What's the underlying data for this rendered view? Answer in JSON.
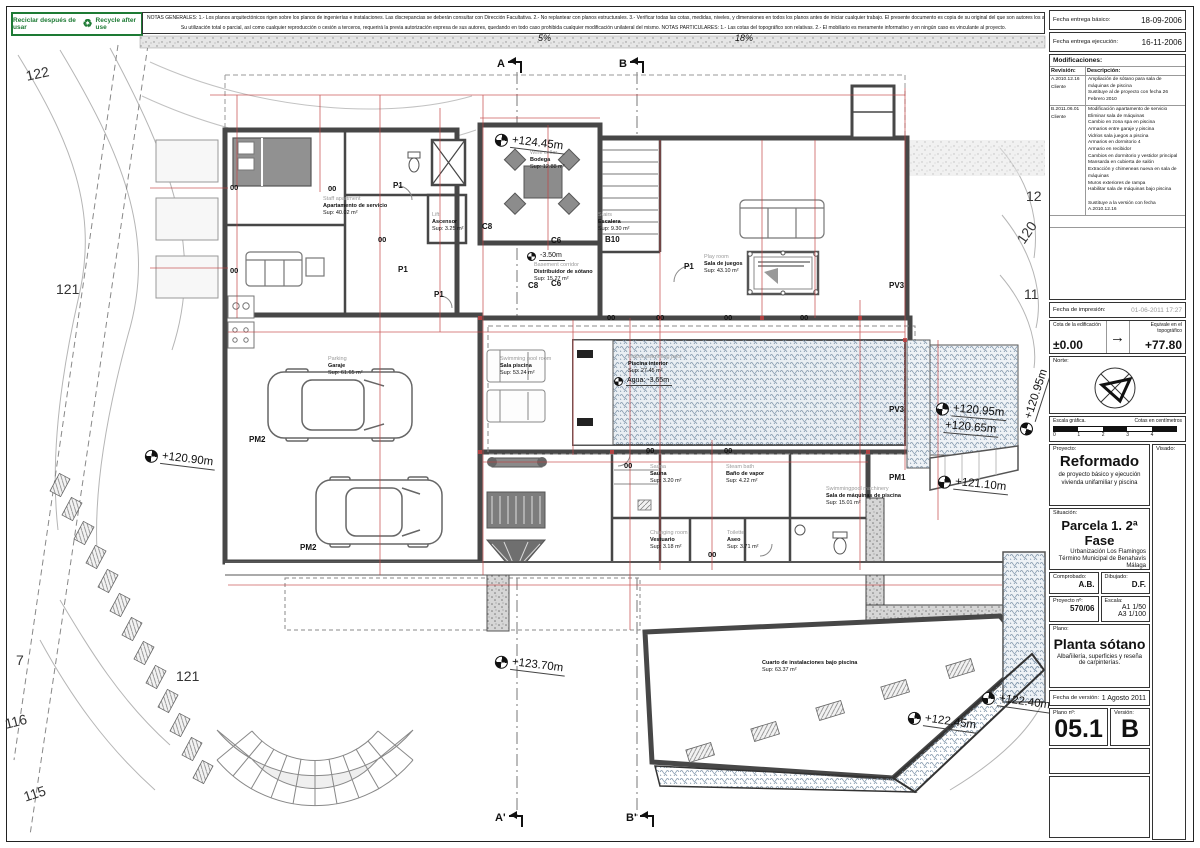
{
  "sheet": {
    "recycle_left": "Reciclar después de usar",
    "recycle_right": "Recycle after use",
    "notes_line1": "NOTAS GENERALES:   1.- Los planos arquitectónicos rigen sobre los planos de ingenierías e instalaciones. Las discrepancias se deberán consultar con Dirección Facultativa.   2.- No replantear con planos estructurales.   3.- Verificar todas las cotas, medidas, niveles, y dimensiones en todos los planos antes de iniciar cualquier trabajo. El presente documento es copia de su original del que son autores los arquitectos",
    "notes_line2": "Su utilización total o parcial, así como cualquier reproducción o cesión a terceros, requerirá la previa autorización expresa de sus autores, quedando en todo caso prohibida cualquier modificación unilateral del mismo.   NOTAS PARTICULARES:   1.- Las cotas del topográfico son relativas. 2.- El mobiliario es meramente informativo y en ningún caso es vinculante al proyecto."
  },
  "titleblock": {
    "fecha_basico_label": "Fecha entrega básico:",
    "fecha_basico": "18-09-2006",
    "fecha_ejecucion_label": "Fecha entrega ejecución:",
    "fecha_ejecucion": "16-11-2006",
    "modificaciones_label": "Modificaciones:",
    "revision_col": "Revisión:",
    "descripcion_col": "Descripción:",
    "revisions": [
      {
        "rev": "A.2010.12.16",
        "by": "Cliente",
        "desc": "Ampliación de sótano para sala de máquinas de piscina\nSustituye al de proyecto con fecha 26 Febrero 2010"
      },
      {
        "rev": "B.2011.06.01",
        "by": "Cliente",
        "desc": "Modificación apartamento de servicio\nEliminar sala de máquinas\nCambio en zona spa en piscina\nArmarios entre garaje y piscina\nVidrios sala juegos a piscina\nArmarios en dormitorio 4\nArmario en recibidor\nCambios en dormitorio y vestidor principal\nMansarda en cubierta de salón\nExtracción y chimeneas nueva en sala de máquinas\nMuros exteriores de rampa\nHabilitar sala de máquinas bajo piscina\n\nSustituye a la versión con fecha A.2010.12.16"
      }
    ],
    "fecha_impresion_label": "Fecha de impresión:",
    "fecha_impresion": "01-06-2011 17:27",
    "cota_label": "Cota de la edificación",
    "cota_value": "±0.00",
    "equiv_label": "Equivale en el topográfico",
    "equiv_value": "+77.80",
    "norte_label": "Norte:",
    "escala_grafica_label": "Escala gráfica.",
    "cotas_cm_label": "Cotas en centímetros",
    "scale_ticks": [
      "0",
      "1",
      "2",
      "3",
      "4"
    ],
    "proyecto_label": "Proyecto:",
    "visado_label": "Visado:",
    "proyecto_title": "Reformado",
    "proyecto_sub1": "de proyecto básico y ejecución",
    "proyecto_sub2": "vivienda unifamiliar y piscina",
    "situacion_label": "Situación:",
    "situacion_title": "Parcela 1. 2ª Fase",
    "situacion_lines": [
      "Urbanización Los Flamingos",
      "Término Municipal de Benahavís",
      "Málaga"
    ],
    "comprobado_label": "Comprobado:",
    "comprobado": "A.B.",
    "dibujado_label": "Dibujado:",
    "dibujado": "D.F.",
    "proyecto_num_label": "Proyecto nº:",
    "proyecto_num": "570/06",
    "escala_label": "Escala:",
    "escala_1": "A1 1/50",
    "escala_2": "A3 1/100",
    "plano_label": "Plano:",
    "plano_title": "Planta sótano",
    "plano_sub": "Albañilería, superficies y reseña de carpinterías.",
    "fecha_version_label": "Fecha de versión:",
    "fecha_version": "1 Agosto 2011",
    "plano_num_label": "Plano nº:",
    "plano_num": "05.1",
    "version_label": "Versión:",
    "version": "B"
  },
  "plan": {
    "rooms": [
      {
        "en": "Staff apartment",
        "es": "Apartamento de servicio",
        "sup": "Sup: 40.02 m²",
        "x": 323,
        "y": 196
      },
      {
        "en": "Wine cellar",
        "es": "Bodega",
        "sup": "Sup: 12.88 m²",
        "x": 530,
        "y": 150
      },
      {
        "en": "Lift",
        "es": "Ascensor",
        "sup": "Sup: 3.25 m²",
        "x": 432,
        "y": 212
      },
      {
        "en": "Stairs",
        "es": "Escalera",
        "sup": "Sup: 9.30 m²",
        "x": 598,
        "y": 212
      },
      {
        "en": "Play room",
        "es": "Sala de juegos",
        "sup": "Sup: 43.10 m²",
        "x": 704,
        "y": 254
      },
      {
        "en": "Basement corridor",
        "es": "Distribuidor de sótano",
        "sup": "Sup: 15.27 m²",
        "x": 534,
        "y": 262
      },
      {
        "en": "Swimming pool room",
        "es": "Sala piscina",
        "sup": "Sup: 53.24 m²",
        "x": 500,
        "y": 356
      },
      {
        "en": "Indoor swimming pool",
        "es": "Piscina interior",
        "sup": "Sup: 27.45 m²",
        "x": 628,
        "y": 354
      },
      {
        "en": "Parking",
        "es": "Garaje",
        "sup": "Sup: 61.65 m²",
        "x": 328,
        "y": 356
      },
      {
        "en": "Sauna",
        "es": "Sauna",
        "sup": "Sup: 3.20 m²",
        "x": 650,
        "y": 464
      },
      {
        "en": "Steam bath",
        "es": "Baño de vapor",
        "sup": "Sup: 4.22 m²",
        "x": 726,
        "y": 464
      },
      {
        "en": "Changing room",
        "es": "Vestuario",
        "sup": "Sup: 3.18 m²",
        "x": 650,
        "y": 530
      },
      {
        "en": "Toilette",
        "es": "Aseo",
        "sup": "Sup: 3.71 m²",
        "x": 727,
        "y": 530
      },
      {
        "en": "Swimmingpool machinery",
        "es": "Sala de máquinas de piscina",
        "sup": "Sup: 15.01 m²",
        "x": 826,
        "y": 486
      },
      {
        "es": "Cuarto de instalaciones bajo piscina",
        "sup": "Sup: 63.37 m²",
        "x": 762,
        "y": 660
      }
    ],
    "elevations": [
      {
        "text": "+124.45m",
        "x": 495,
        "y": 132,
        "rot": 7
      },
      {
        "text": "+120.90m",
        "x": 145,
        "y": 448,
        "rot": 7
      },
      {
        "text": "+120.95m",
        "x": 936,
        "y": 401,
        "rot": 5
      },
      {
        "text": "+120.65m",
        "x": 944,
        "y": 419,
        "rot": 5,
        "marker": false
      },
      {
        "text": "+120.95m",
        "x": 1024,
        "y": 428,
        "rot": -72
      },
      {
        "text": "+121.10m",
        "x": 938,
        "y": 474,
        "rot": 6
      },
      {
        "text": "+123.70m",
        "x": 495,
        "y": 654,
        "rot": 7
      },
      {
        "text": "+122.45m",
        "x": 908,
        "y": 710,
        "rot": 8
      },
      {
        "text": "+122.40m",
        "x": 982,
        "y": 690,
        "rot": 8
      },
      {
        "text": "-3.50m",
        "x": 527,
        "y": 252,
        "rot": 0,
        "small": true
      },
      {
        "text": "Agua: -3.65m",
        "x": 614,
        "y": 377,
        "rot": 0,
        "small": true
      }
    ],
    "codes": [
      {
        "t": "P1",
        "x": 393,
        "y": 181
      },
      {
        "t": "P1",
        "x": 398,
        "y": 265
      },
      {
        "t": "P1",
        "x": 434,
        "y": 290
      },
      {
        "t": "P1",
        "x": 684,
        "y": 262
      },
      {
        "t": "C8",
        "x": 482,
        "y": 222
      },
      {
        "t": "C8",
        "x": 528,
        "y": 281
      },
      {
        "t": "C6",
        "x": 551,
        "y": 236
      },
      {
        "t": "C6",
        "x": 551,
        "y": 279
      },
      {
        "t": "B10",
        "x": 605,
        "y": 235
      },
      {
        "t": "PV3",
        "x": 889,
        "y": 281
      },
      {
        "t": "PV3",
        "x": 889,
        "y": 405
      },
      {
        "t": "PM1",
        "x": 889,
        "y": 473
      },
      {
        "t": "PM2",
        "x": 249,
        "y": 435
      },
      {
        "t": "PM2",
        "x": 300,
        "y": 543
      }
    ],
    "zero_text": "00",
    "zeros": [
      [
        230,
        183
      ],
      [
        230,
        266
      ],
      [
        328,
        184
      ],
      [
        378,
        235
      ],
      [
        607,
        313
      ],
      [
        656,
        313
      ],
      [
        724,
        313
      ],
      [
        800,
        313
      ],
      [
        646,
        446
      ],
      [
        724,
        446
      ],
      [
        624,
        461
      ],
      [
        708,
        550
      ]
    ],
    "contours": [
      {
        "t": "122",
        "x": 26,
        "y": 68,
        "r": -12
      },
      {
        "t": "121",
        "x": 56,
        "y": 281,
        "r": 0
      },
      {
        "t": "7",
        "x": 16,
        "y": 652,
        "r": 0
      },
      {
        "t": "116",
        "x": 5,
        "y": 716,
        "r": -14
      },
      {
        "t": "115",
        "x": 24,
        "y": 789,
        "r": -18
      },
      {
        "t": "121",
        "x": 176,
        "y": 668,
        "r": 0
      },
      {
        "t": "12",
        "x": 1026,
        "y": 188,
        "r": 0
      },
      {
        "t": "120",
        "x": 1020,
        "y": 234,
        "r": -55
      },
      {
        "t": "11",
        "x": 1024,
        "y": 286,
        "r": 0
      }
    ],
    "sections": [
      {
        "t": "A",
        "x": 497,
        "y": 58
      },
      {
        "t": "B",
        "x": 619,
        "y": 58
      },
      {
        "t": "A'",
        "x": 495,
        "y": 812
      },
      {
        "t": "B'",
        "x": 626,
        "y": 812
      }
    ],
    "slopes": [
      {
        "t": "5%",
        "x": 538,
        "y": 33
      },
      {
        "t": "18%",
        "x": 735,
        "y": 33
      }
    ]
  }
}
